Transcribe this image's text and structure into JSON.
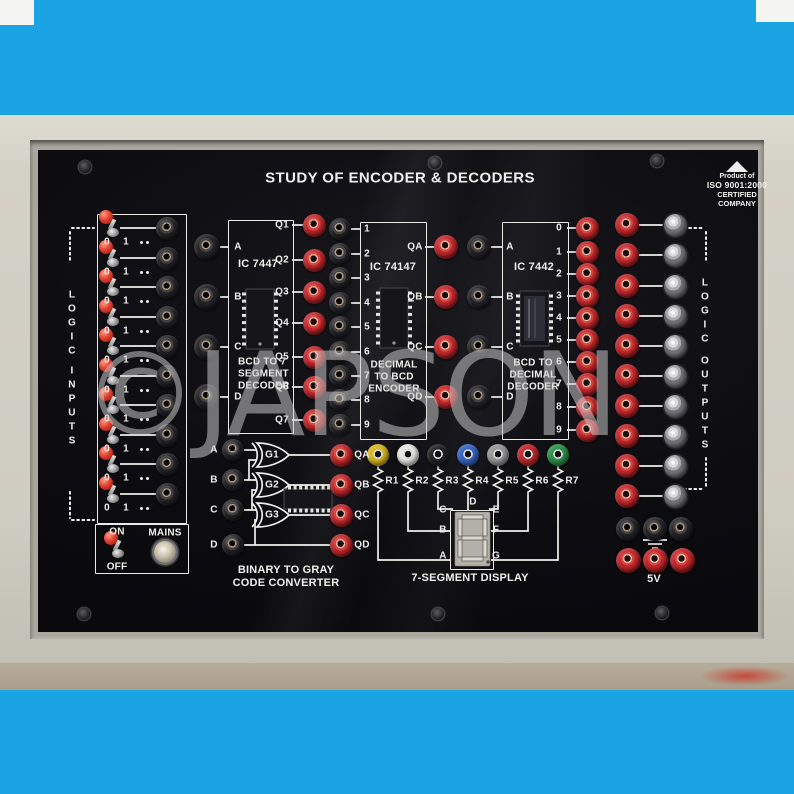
{
  "product": {
    "title": "STUDY OF ENCODER & DECODERS",
    "watermark": "©JAPSON"
  },
  "badge": {
    "line1": "Product of",
    "line2": "ISO 9001:2000",
    "line3": "CERTIFIED COMPANY"
  },
  "logic_inputs": {
    "label": "LOGIC INPUTS",
    "rows": 10,
    "zero": "0",
    "one": "1"
  },
  "power": {
    "on": "ON",
    "off": "OFF",
    "mains": "MAINS"
  },
  "decoder_7447": {
    "name": "IC 7447",
    "desc": [
      "BCD TO 7",
      "SEGMENT",
      "DECODER"
    ],
    "inputs": [
      "A",
      "B",
      "C",
      "D"
    ],
    "outputs": [
      "Q1",
      "Q2",
      "Q3",
      "Q4",
      "Q5",
      "Q6",
      "Q7"
    ]
  },
  "encoder_74147": {
    "name": "IC 74147",
    "desc": [
      "DECIMAL",
      "TO BCD",
      "ENCODER"
    ],
    "inputs": [
      "1",
      "2",
      "3",
      "4",
      "5",
      "6",
      "7",
      "8",
      "9"
    ],
    "outputs": [
      "QA",
      "QB",
      "QC",
      "QD"
    ]
  },
  "decoder_7442": {
    "name": "IC 7442",
    "desc": [
      "BCD TO",
      "DECIMAL",
      "DECODER"
    ],
    "inputs": [
      "A",
      "B",
      "C",
      "D"
    ],
    "outputs": [
      "0",
      "1",
      "2",
      "3",
      "4",
      "5",
      "6",
      "7",
      "8",
      "9"
    ]
  },
  "logic_outputs": {
    "label": "LOGIC OUTPUTS",
    "leds": 10
  },
  "binary_gray": {
    "title": [
      "BINARY TO GRAY",
      "CODE CONVERTER"
    ],
    "inputs": [
      "A",
      "B",
      "C",
      "D"
    ],
    "gates": [
      "G1",
      "G2",
      "G3"
    ],
    "outputs": [
      "QA",
      "QB",
      "QC",
      "QD"
    ]
  },
  "seven_segment": {
    "title": "7-SEGMENT DISPLAY",
    "resistors": [
      "R1",
      "R2",
      "R3",
      "R4",
      "R5",
      "R6",
      "R7"
    ],
    "socket_colors": [
      "#d8b71e",
      "#e6e6e2",
      "#232326",
      "#3565c4",
      "#97979a",
      "#c1272d",
      "#2c9247"
    ],
    "segments": [
      "A",
      "B",
      "C",
      "D",
      "E",
      "F",
      "G"
    ],
    "digit": "8"
  },
  "supply": {
    "label": "5V"
  },
  "colors": {
    "backdrop": "#1ba4e4",
    "case": "#d4d1c7",
    "panel": "#0c0c10",
    "socket_red": "#c1272d",
    "line_white": "#f0efec"
  }
}
